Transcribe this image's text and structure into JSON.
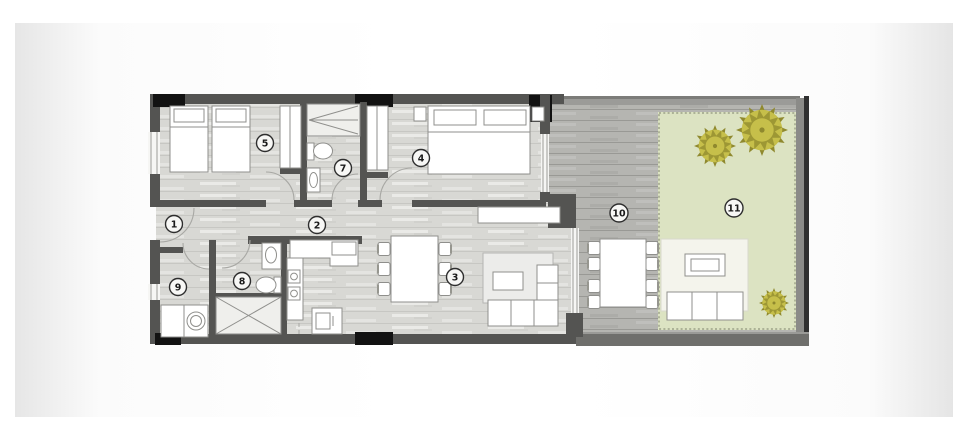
{
  "colors": {
    "wall": "#545452",
    "pillar": "#121212",
    "floor": "#d8d8d4",
    "terrace": "#b5b5b1",
    "garden": "#dce3c2",
    "garden_border": "#8f957c",
    "furniture_fill": "#ffffff",
    "furniture_stroke": "#8f8f8c",
    "glass": "#9c9c99",
    "tree_light": "#c6bf4a",
    "tree_dark": "#8f892e",
    "label_stroke": "#2e2e2e",
    "label_text": "#1a1a1a"
  },
  "floor_plan": {
    "room_labels": [
      {
        "number": "1"
      },
      {
        "number": "2"
      },
      {
        "number": "3"
      },
      {
        "number": "4"
      },
      {
        "number": "5"
      },
      {
        "number": "7"
      },
      {
        "number": "8"
      },
      {
        "number": "9"
      },
      {
        "number": "10"
      },
      {
        "number": "11"
      }
    ]
  }
}
